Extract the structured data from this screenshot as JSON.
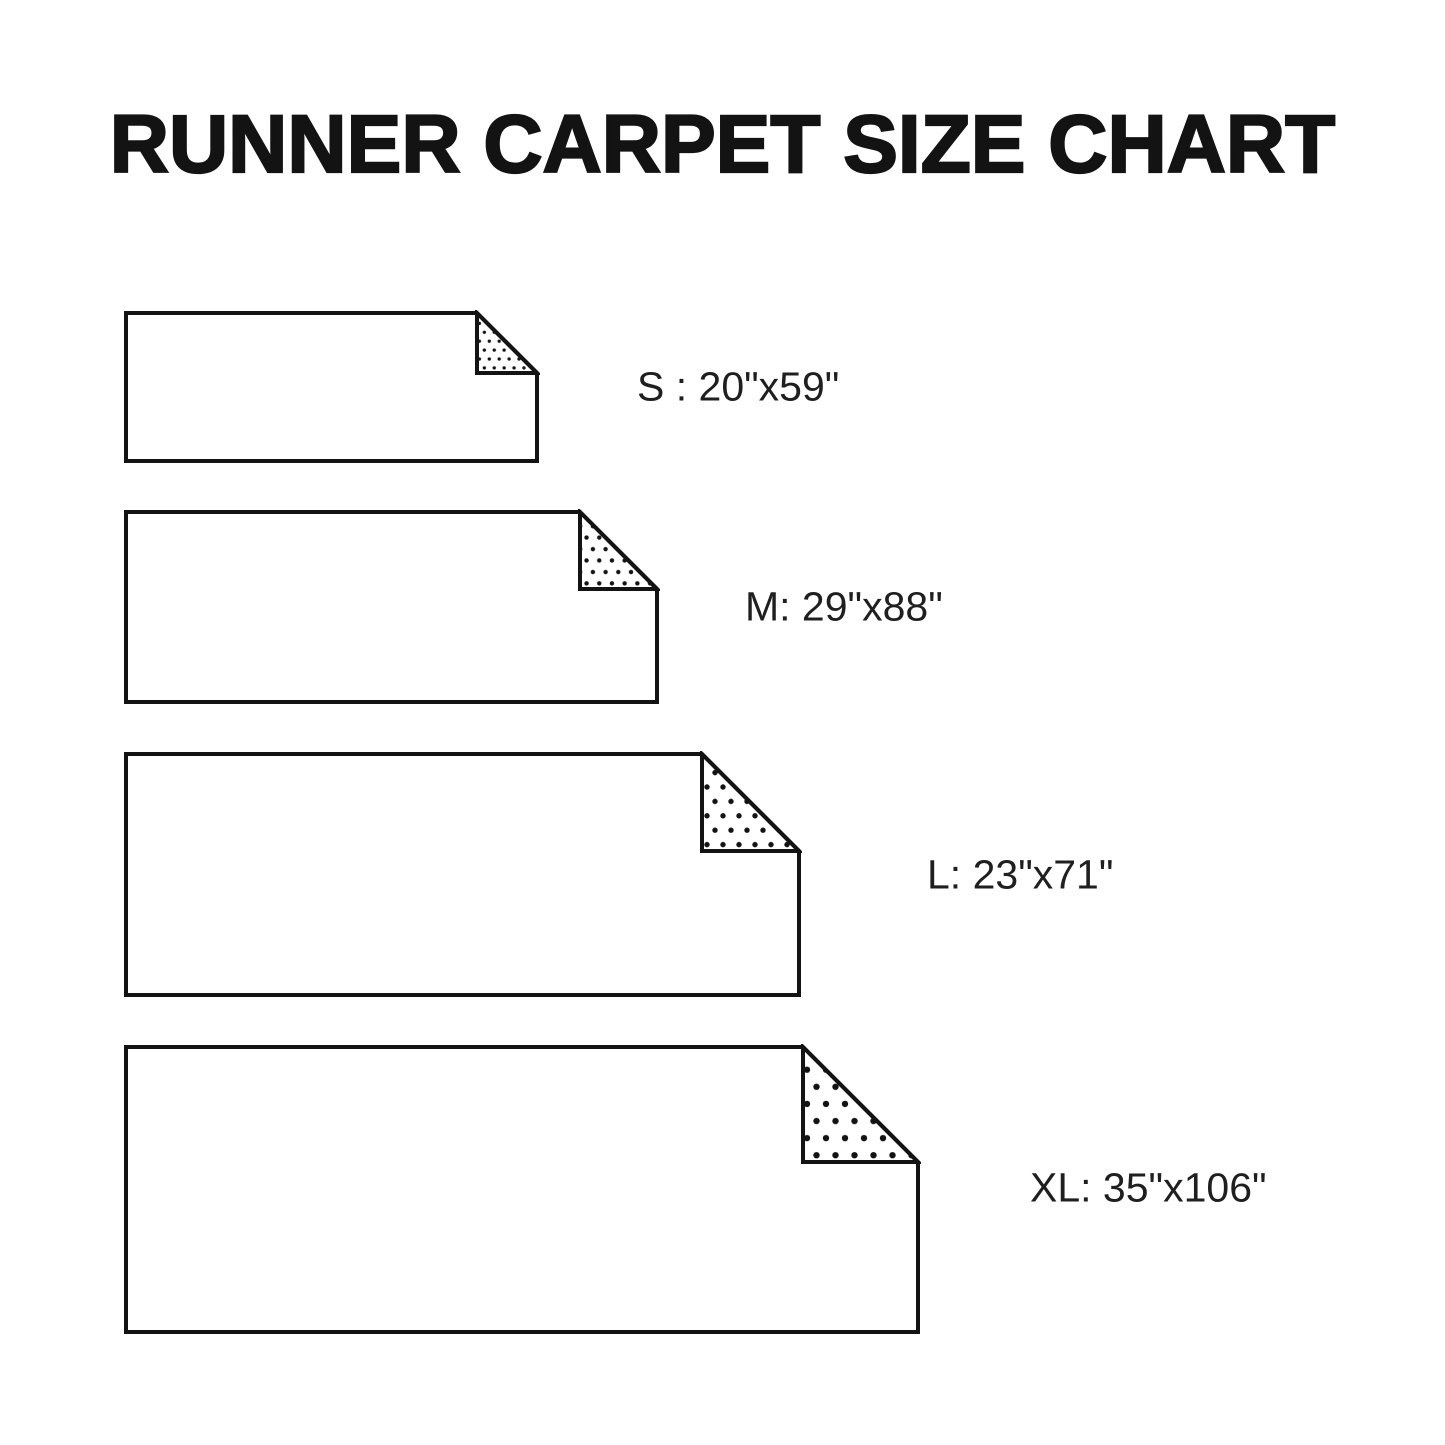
{
  "page": {
    "title": "RUNNER CARPET SIZE CHART",
    "background_color": "#ffffff",
    "ink_color": "#131313",
    "label_color": "#1f1f1f",
    "carpet_fill": "#ffffff"
  },
  "carpets": [
    {
      "size_code": "S",
      "label": "S : 20\"x59\"",
      "width_in": 20,
      "length_in": 59,
      "box": {
        "left": 126,
        "top": 313,
        "width": 411,
        "height": 148,
        "fold": 60
      },
      "label_pos": {
        "x": 637,
        "y": 387
      }
    },
    {
      "size_code": "M",
      "label": "M: 29\"x88\"",
      "width_in": 29,
      "length_in": 88,
      "box": {
        "left": 126,
        "top": 512,
        "width": 531,
        "height": 190,
        "fold": 77
      },
      "label_pos": {
        "x": 745,
        "y": 607
      }
    },
    {
      "size_code": "L",
      "label": "L: 23\"x71\"",
      "width_in": 23,
      "length_in": 71,
      "box": {
        "left": 126,
        "top": 754,
        "width": 673,
        "height": 241,
        "fold": 97
      },
      "label_pos": {
        "x": 927,
        "y": 875
      }
    },
    {
      "size_code": "XL",
      "label": "XL: 35\"x106\"",
      "width_in": 35,
      "length_in": 106,
      "box": {
        "left": 126,
        "top": 1047,
        "width": 792,
        "height": 285,
        "fold": 115
      },
      "label_pos": {
        "x": 1030,
        "y": 1188
      }
    }
  ]
}
